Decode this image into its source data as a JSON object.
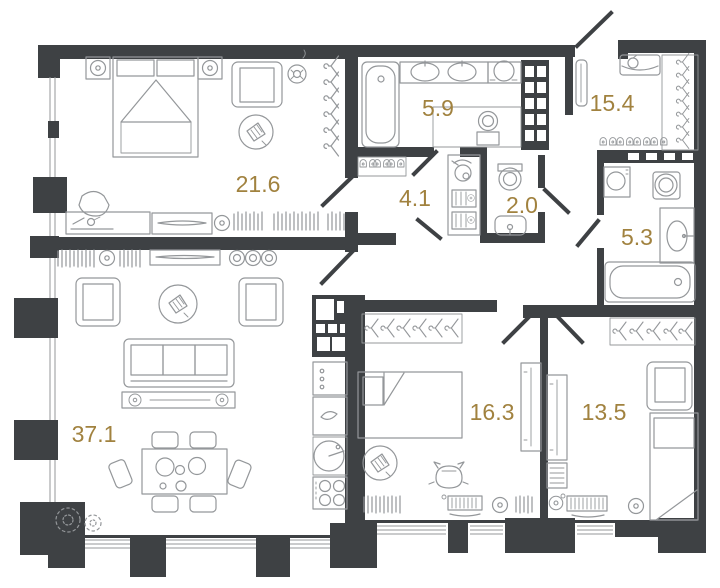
{
  "title": "Apartment floor plan",
  "colors": {
    "wall": "#3e4144",
    "furniture_line": "#94979a",
    "label": "#a1823f",
    "background": "#ffffff"
  },
  "rooms": [
    {
      "name": "bedroom-master",
      "area": "21.6",
      "furniture": [
        "double-bed",
        "nightstand-lamp",
        "nightstand-lamp",
        "armchair",
        "ceiling-fan",
        "rug-with-plant",
        "hanger-rail",
        "pouf",
        "dresser",
        "console",
        "radiator",
        "window-wall"
      ]
    },
    {
      "name": "bathroom-main",
      "area": "5.9",
      "furniture": [
        "bathtub",
        "double-sink-vanity",
        "round-basin",
        "toilet",
        "utility-shaft"
      ]
    },
    {
      "name": "hallway",
      "area": "4.1",
      "furniture": [
        "shoe-rack",
        "vacuum-cleaner",
        "drawer-unit",
        "drawer-unit"
      ]
    },
    {
      "name": "wc",
      "area": "2.0",
      "furniture": [
        "toilet",
        "washbasin"
      ]
    },
    {
      "name": "entry-hall",
      "area": "15.4",
      "furniture": [
        "console-basin",
        "mirror",
        "hanger-rail",
        "shoe-rack",
        "entrance-door"
      ]
    },
    {
      "name": "bathroom-second",
      "area": "5.3",
      "furniture": [
        "washing-machine",
        "dryer",
        "washbasin-counter",
        "bathtub"
      ]
    },
    {
      "name": "living-kitchen",
      "area": "37.1",
      "furniture": [
        "armchair",
        "armchair",
        "rug-with-plant",
        "sofa",
        "tv-stand",
        "media-console",
        "dining-table",
        "chairs",
        "plants",
        "kitchen-cabinets",
        "oven",
        "kitchen-sink",
        "round-table",
        "cooktop",
        "radiator",
        "window-wall"
      ]
    },
    {
      "name": "bedroom-middle",
      "area": "16.3",
      "furniture": [
        "hanger-rail",
        "single-bed",
        "rug-with-plant",
        "cat",
        "radiator",
        "desk-computer",
        "stool",
        "wardrobe-panel"
      ]
    },
    {
      "name": "bedroom-right",
      "area": "13.5",
      "furniture": [
        "hanger-rail",
        "armchair",
        "single-bed",
        "wardrobe-panel",
        "shelf-unit",
        "desk-computer",
        "stool"
      ]
    }
  ]
}
